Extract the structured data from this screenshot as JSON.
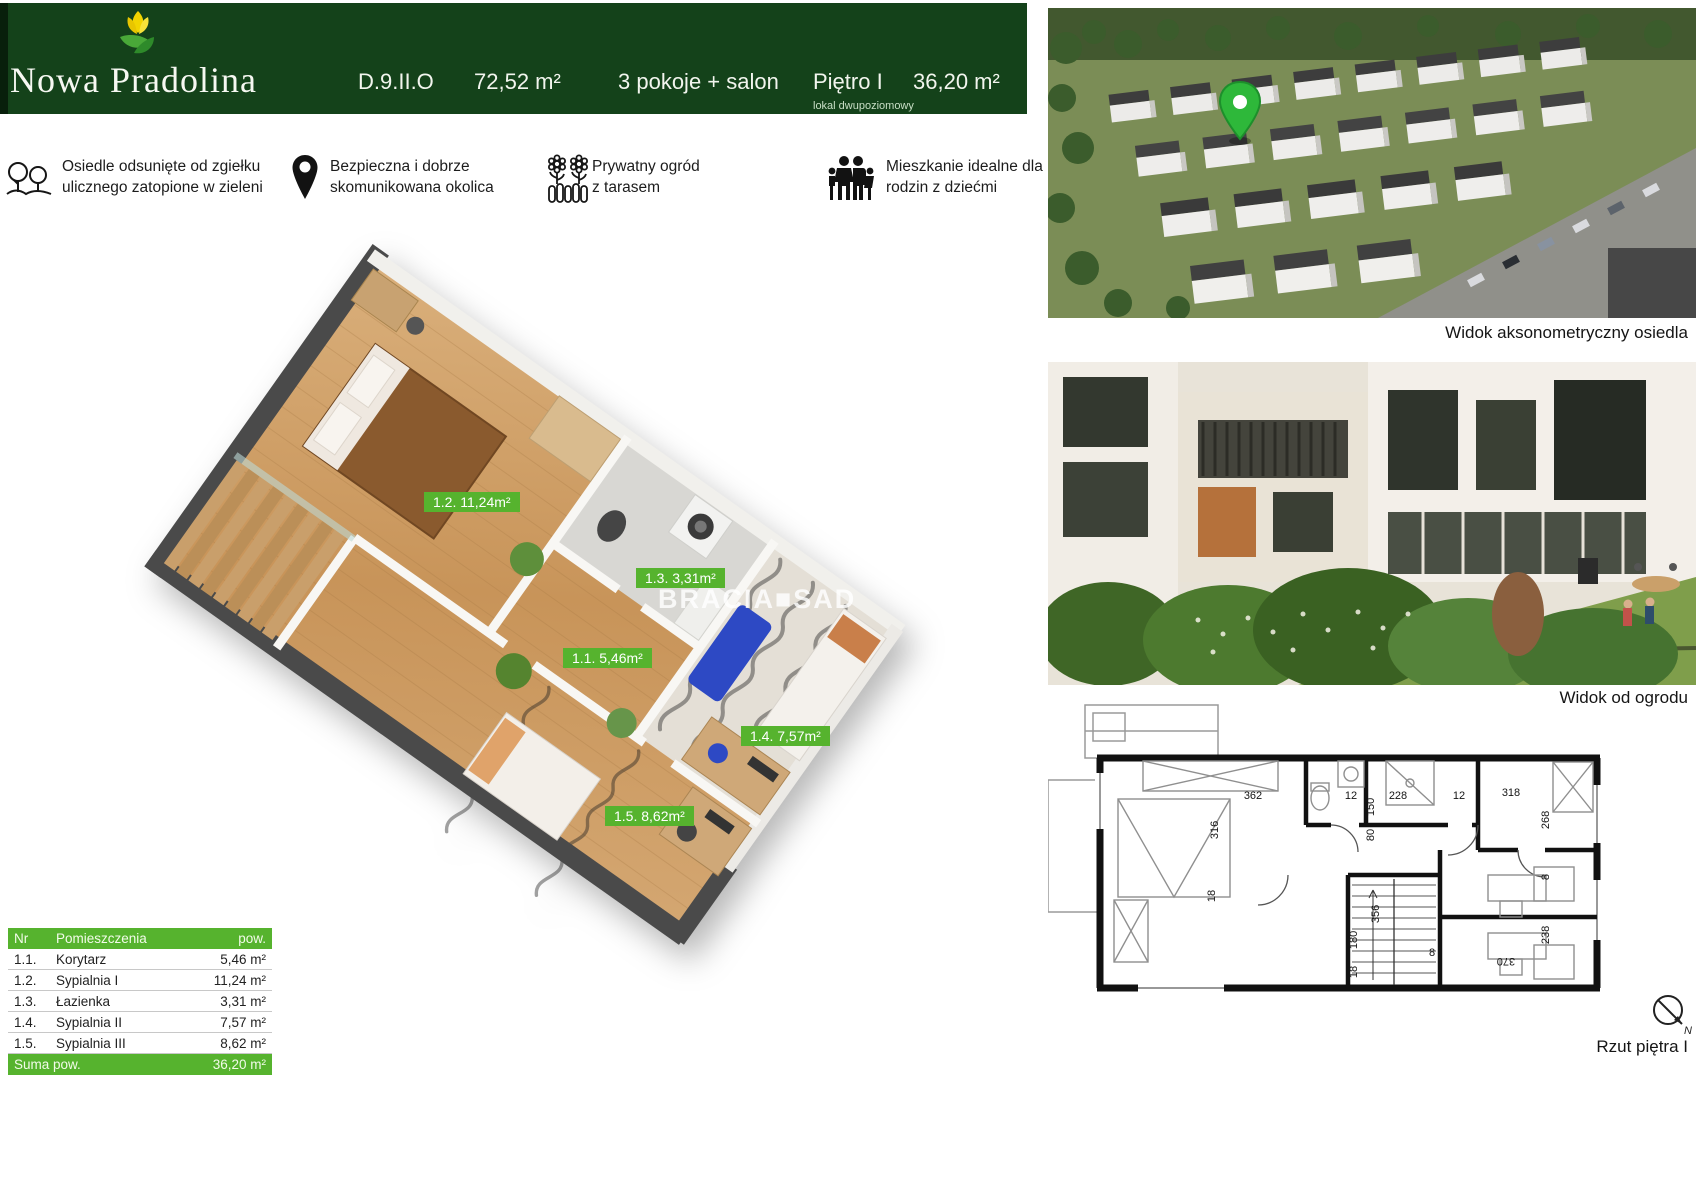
{
  "header": {
    "brand": "Nowa Pradolina",
    "unit_code": "D.9.II.O",
    "total_area": "72,52 m²",
    "rooms": "3 pokoje + salon",
    "floor": "Piętro I",
    "floor_note": "lokal dwupoziomowy",
    "floor_area": "36,20 m²",
    "bg_color": "#14421a"
  },
  "features": [
    {
      "icon": "trees-icon",
      "line1": "Osiedle odsunięte od zgiełku",
      "line2": "ulicznego zatopione w zieleni"
    },
    {
      "icon": "location-pin-icon",
      "line1": "Bezpieczna i dobrze",
      "line2": "skomunikowana okolica"
    },
    {
      "icon": "garden-icon",
      "line1": "Prywatny ogród",
      "line2": "z tarasem"
    },
    {
      "icon": "family-icon",
      "line1": "Mieszkanie idealne dla",
      "line2": "rodzin z dziećmi"
    }
  ],
  "floorplan3d": {
    "labels": [
      "1.2. 11,24m²",
      "1.3. 3,31m²",
      "1.1. 5,46m²",
      "1.4. 7,57m²",
      "1.5. 8,62m²"
    ],
    "watermark": "BRACIA■SAD",
    "label_color": "#56b32e"
  },
  "rooms_table": {
    "headers": {
      "nr": "Nr",
      "name": "Pomieszczenia",
      "area": "pow."
    },
    "rows": [
      {
        "nr": "1.1.",
        "name": "Korytarz",
        "area": "5,46 m²"
      },
      {
        "nr": "1.2.",
        "name": "Sypialnia I",
        "area": "11,24 m²"
      },
      {
        "nr": "1.3.",
        "name": "Łazienka",
        "area": "3,31 m²"
      },
      {
        "nr": "1.4.",
        "name": "Sypialnia II",
        "area": "7,57 m²"
      },
      {
        "nr": "1.5.",
        "name": "Sypialnia III",
        "area": "8,62 m²"
      }
    ],
    "footer": {
      "label": "Suma pow.",
      "value": "36,20 m²"
    },
    "accent_color": "#56b32e"
  },
  "right_panel": {
    "photo1_caption": "Widok aksonometryczny osiedla",
    "photo2_caption": "Widok od ogrodu",
    "plan_caption": "Rzut piętra I",
    "compass_letter": "N"
  },
  "plan2d": {
    "dims": [
      "362",
      "12",
      "150",
      "228",
      "12",
      "318",
      "316",
      "18",
      "80",
      "268",
      "8",
      "238",
      "370",
      "8",
      "356",
      "180",
      "18"
    ]
  }
}
